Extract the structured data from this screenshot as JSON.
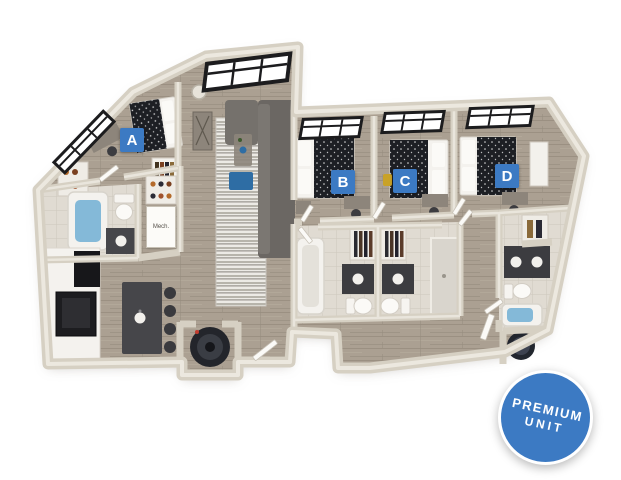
{
  "unit": {
    "rooms": [
      {
        "label": "A"
      },
      {
        "label": "B"
      },
      {
        "label": "C"
      },
      {
        "label": "D"
      }
    ],
    "mech_label": "Mech.",
    "badge": {
      "line1": "PREMIUM",
      "line2": "UNIT"
    }
  },
  "colors": {
    "room_label_blue": "#3c7ac3",
    "badge_blue": "#3c7ac3",
    "badge_text": "#ffffff",
    "wall_cream": "#d6d0c3",
    "wall_highlight": "#ece8df",
    "floor_wood": "#aba092",
    "bath_tile": "#e0dbd2",
    "bed_duvet": "#1d1f24",
    "tub_water": "#84b9d8",
    "kitchen_island": "#46464a",
    "ottoman_blue": "#2e6da4",
    "sofa_gray": "#6b6763",
    "window_frame": "#1c1c1e",
    "background": "#ffffff"
  }
}
